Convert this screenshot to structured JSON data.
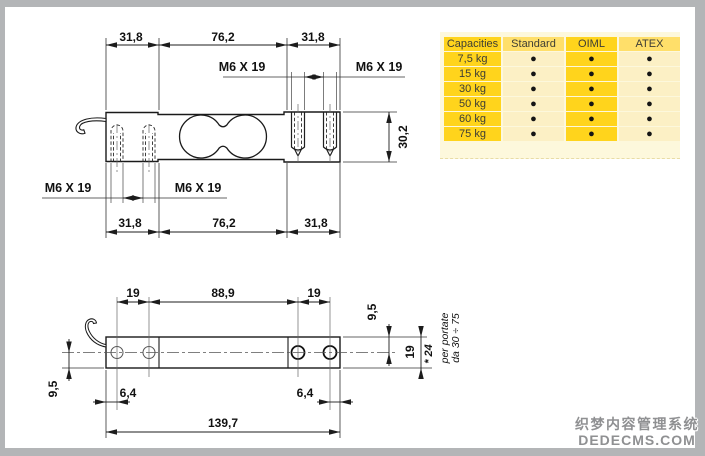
{
  "top_view": {
    "dim_a": "31,8",
    "dim_b": "76,2",
    "thread": "M6 X 19",
    "height": "30,2"
  },
  "side_view": {
    "pitch": "19",
    "span": "88,9",
    "edge": "6,4",
    "total": "139,7",
    "half": "9,5",
    "height": "19",
    "alt_height": "* 24",
    "note_line1": "per portate",
    "note_line2": "da 30 ÷ 75"
  },
  "capacity_table": {
    "dot": "●",
    "columns": [
      "Capacities",
      "Standard",
      "OIML",
      "ATEX"
    ],
    "rows": [
      {
        "capacity": "7,5 kg",
        "standard": "●",
        "oiml": "●",
        "atex": "●"
      },
      {
        "capacity": "15 kg",
        "standard": "●",
        "oiml": "●",
        "atex": "●"
      },
      {
        "capacity": "30 kg",
        "standard": "●",
        "oiml": "●",
        "atex": "●"
      },
      {
        "capacity": "50 kg",
        "standard": "●",
        "oiml": "●",
        "atex": "●"
      },
      {
        "capacity": "60 kg",
        "standard": "●",
        "oiml": "●",
        "atex": "●"
      },
      {
        "capacity": "75 kg",
        "standard": "●",
        "oiml": "●",
        "atex": "●"
      }
    ]
  },
  "watermark": {
    "line1": "织梦内容管理系统",
    "line2": "DEDECMS.COM"
  }
}
